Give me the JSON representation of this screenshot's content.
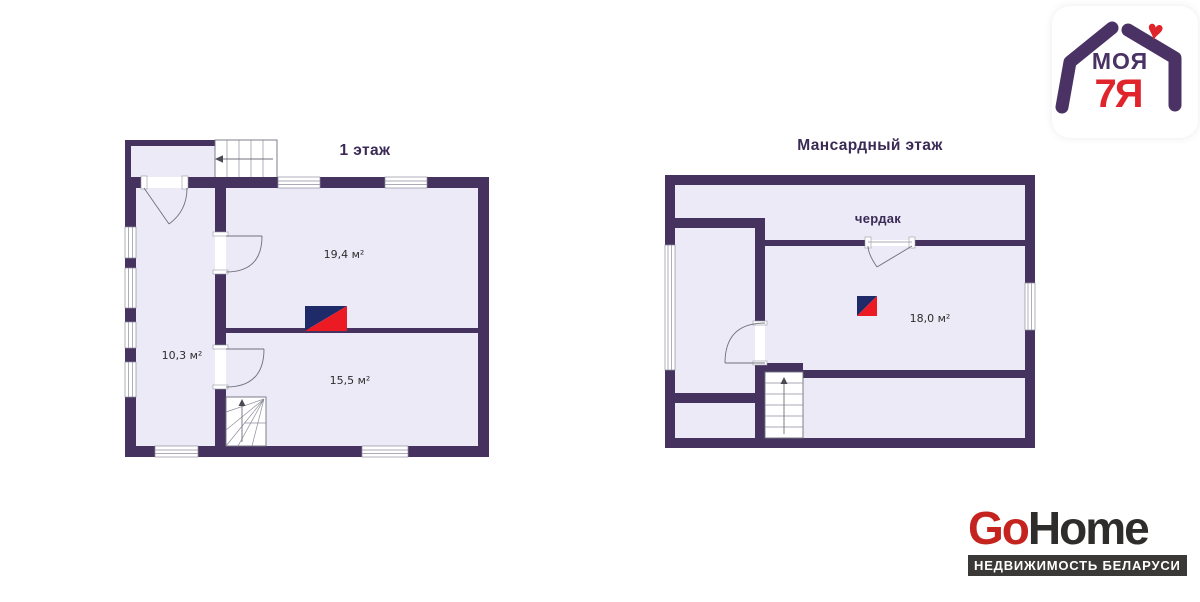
{
  "colors": {
    "wall": "#46325f",
    "floor": "#ebeaf6",
    "title": "#3a2a55",
    "label": "#2d2d2d",
    "compass_navy": "#1e2b68",
    "compass_red": "#ec1b23",
    "brand_red": "#c5241e",
    "brand_dark": "#2e2d2b",
    "brand_bar": "#3a3937",
    "logo_purple": "#4a3264",
    "logo_red": "#e0242b"
  },
  "plans": [
    {
      "title": "1 этаж",
      "rooms": [
        {
          "label": "19,4 м²"
        },
        {
          "label": "10,3 м²"
        },
        {
          "label": "15,5 м²"
        }
      ]
    },
    {
      "title": "Мансардный этаж",
      "attic_label": "чердак",
      "rooms": [
        {
          "label": "18,0 м²"
        }
      ]
    }
  ],
  "branding": {
    "moya7ya": {
      "line1": "МОЯ",
      "line2": "7Я"
    },
    "gohome": {
      "go": "Go",
      "home": "Home",
      "tagline": "НЕДВИЖИМОСТЬ БЕЛАРУСИ"
    }
  }
}
